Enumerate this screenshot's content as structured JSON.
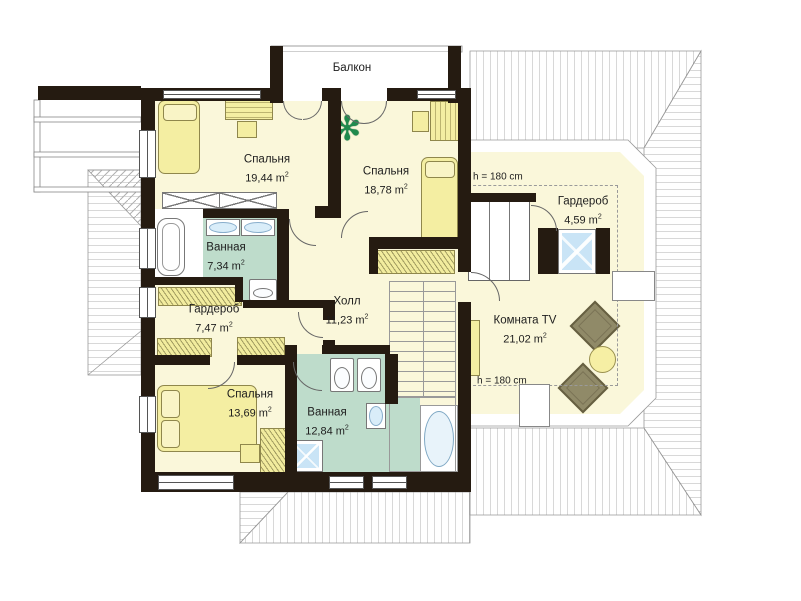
{
  "plan": {
    "balcony_label": "Балкон",
    "unit": "m",
    "unit_exp": "2",
    "height_note": "h = 180 cm",
    "rooms": [
      {
        "id": "bedroom-1",
        "name": "Спальня",
        "area": "19,44"
      },
      {
        "id": "bedroom-2",
        "name": "Спальня",
        "area": "18,78"
      },
      {
        "id": "bathroom-1",
        "name": "Ванная",
        "area": "7,34"
      },
      {
        "id": "wardrobe-1",
        "name": "Гардероб",
        "area": "7,47"
      },
      {
        "id": "hall",
        "name": "Холл",
        "area": "11,23"
      },
      {
        "id": "bedroom-3",
        "name": "Спальня",
        "area": "13,69"
      },
      {
        "id": "bathroom-2",
        "name": "Ванная",
        "area": "12,84"
      },
      {
        "id": "wardrobe-2",
        "name": "Гардероб",
        "area": "4,59"
      },
      {
        "id": "tv-room",
        "name": "Комната TV",
        "area": "21,02"
      }
    ],
    "colors": {
      "wall": "#251B11",
      "floor_cream": "#FAF7DA",
      "bath_green": "#BEDCCB",
      "furniture_yellow": "#F4EEA2",
      "fixture_blue": "#C9E4F6",
      "roof_line": "#B0B0B0"
    }
  }
}
